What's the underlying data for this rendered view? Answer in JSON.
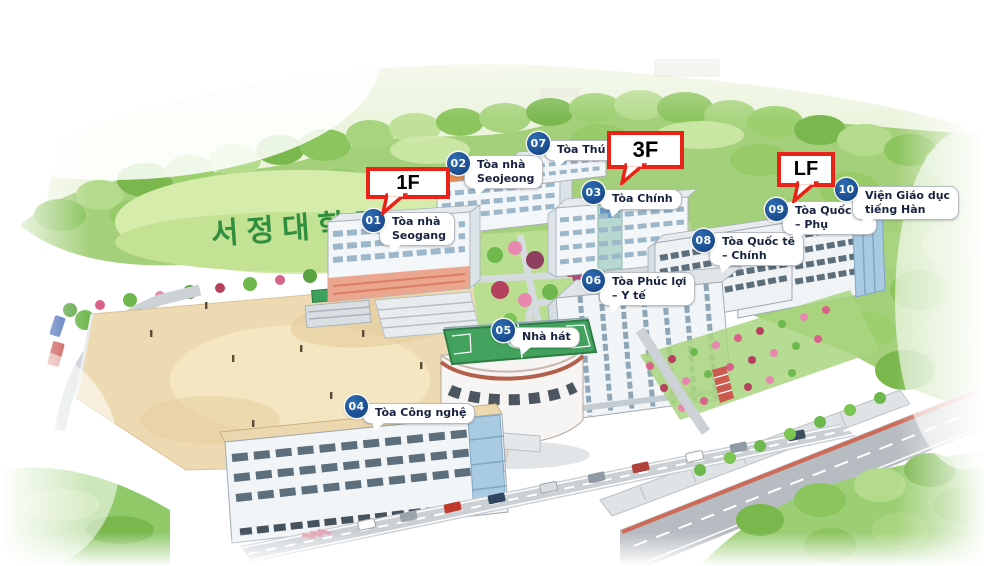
{
  "map": {
    "hillside_text": "서정대학교",
    "markers": [
      {
        "number": "01",
        "lines": [
          "Tòa nhà",
          "Seogang"
        ]
      },
      {
        "number": "02",
        "lines": [
          "Tòa nhà",
          "Seojeong"
        ]
      },
      {
        "number": "03",
        "lines": [
          "Tòa Chính"
        ]
      },
      {
        "number": "04",
        "lines": [
          "Tòa Công nghệ"
        ]
      },
      {
        "number": "05",
        "lines": [
          "Nhà hát"
        ]
      },
      {
        "number": "06",
        "lines": [
          "Tòa Phúc lợi",
          "– Y tế"
        ]
      },
      {
        "number": "07",
        "lines": [
          "Tòa Thú cưng"
        ]
      },
      {
        "number": "08",
        "lines": [
          "Tòa Quốc tế",
          "– Chính"
        ]
      },
      {
        "number": "09",
        "lines": [
          "Tòa Quốc tế",
          "– Phụ"
        ]
      },
      {
        "number": "10",
        "lines": [
          "Viện Giáo dục",
          "tiếng Hàn"
        ]
      }
    ],
    "floor_callouts": [
      {
        "label": "1F"
      },
      {
        "label": "3F"
      },
      {
        "label": "LF"
      }
    ],
    "colors": {
      "marker_blue": "#17549e",
      "callout_red": "#ea2318",
      "bubble_text": "#16223f",
      "hillside_green": "#2f8f3f"
    }
  }
}
